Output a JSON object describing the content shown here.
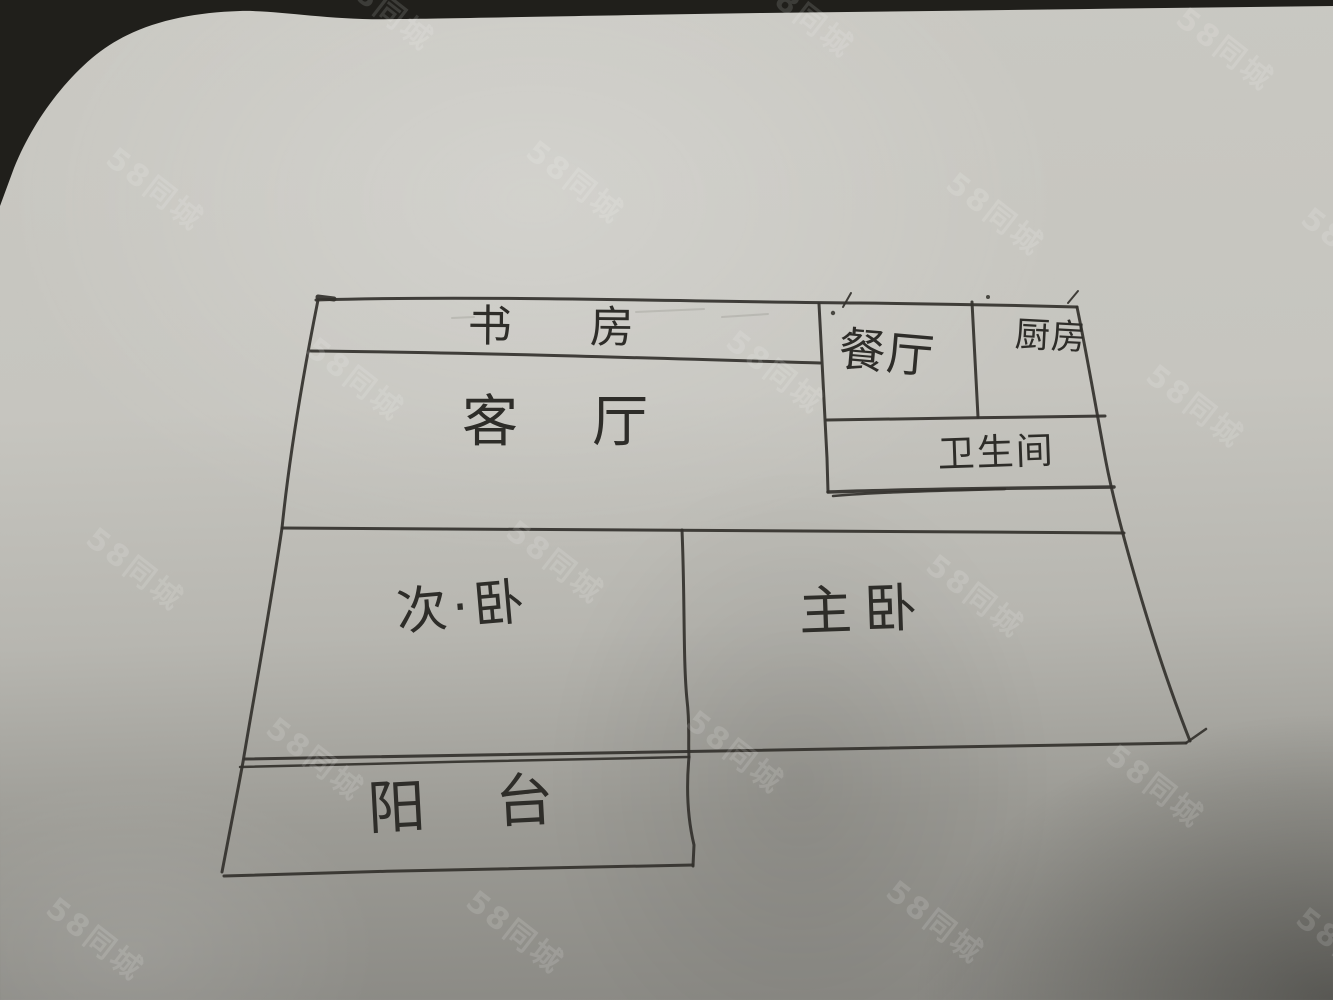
{
  "photo": {
    "description": "Hand-drawn apartment floor plan sketched in pen on gray paper, photographed",
    "paper_color": "#c6c5bf",
    "ink_color": "#33312c",
    "background_dark_color": "#201f1b"
  },
  "rooms": {
    "study": {
      "label": "书房"
    },
    "living_room": {
      "label": "客厅"
    },
    "dining_room": {
      "label": "餐厅"
    },
    "kitchen": {
      "label": "厨房"
    },
    "bathroom": {
      "label": "卫生间"
    },
    "secondary_bedroom": {
      "label": "次·卧"
    },
    "master_bedroom": {
      "label": "主卧"
    },
    "balcony": {
      "label": "阳台"
    }
  },
  "watermarks": {
    "text": "58同城",
    "positions": [
      [
        330,
        -15
      ],
      [
        750,
        -8
      ],
      [
        1170,
        25
      ],
      [
        100,
        165
      ],
      [
        520,
        158
      ],
      [
        940,
        190
      ],
      [
        1295,
        225
      ],
      [
        300,
        355
      ],
      [
        720,
        348
      ],
      [
        1140,
        382
      ],
      [
        80,
        545
      ],
      [
        500,
        538
      ],
      [
        920,
        572
      ],
      [
        260,
        735
      ],
      [
        680,
        728
      ],
      [
        1100,
        762
      ],
      [
        40,
        915
      ],
      [
        460,
        908
      ],
      [
        880,
        898
      ],
      [
        1290,
        925
      ]
    ]
  }
}
